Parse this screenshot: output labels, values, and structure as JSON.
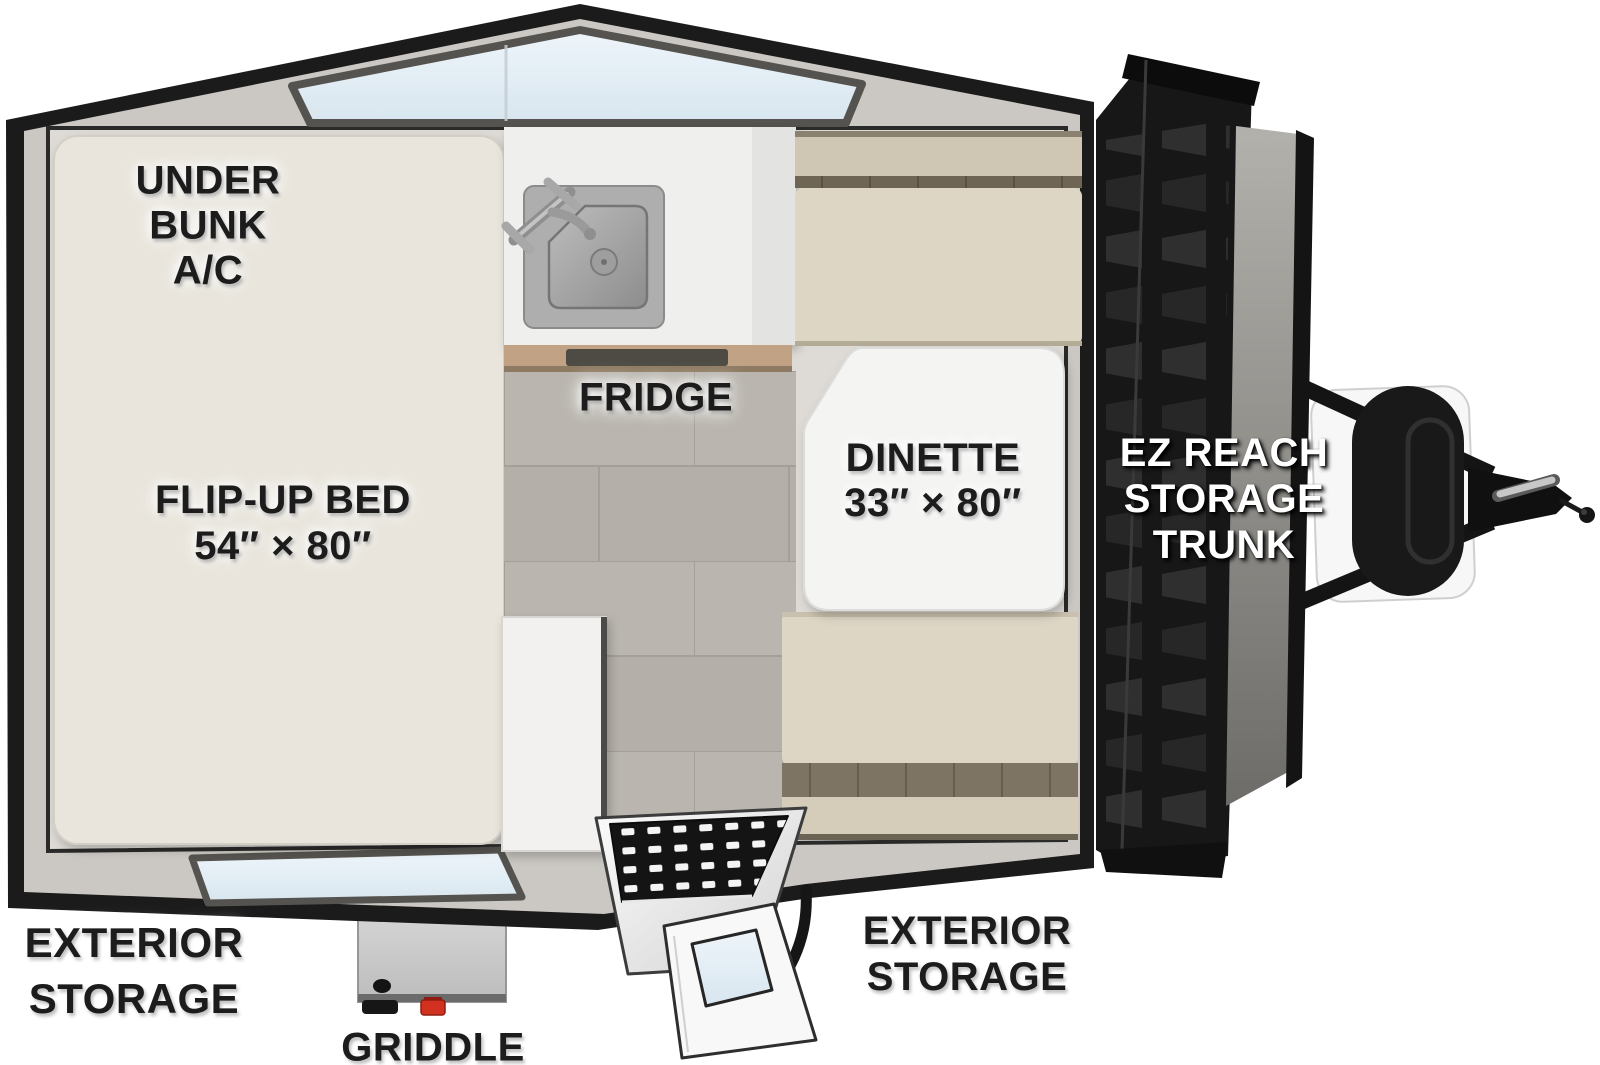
{
  "title": "A-frame camping trailer floorplan",
  "floorplan": {
    "labels": {
      "under_bunk_ac": "UNDER\nBUNK\nA/C",
      "flip_up_bed": "FLIP-UP BED\n54″ × 80″",
      "fridge": "FRIDGE",
      "dinette": "DINETTE\n33″ × 80″",
      "ez_reach_trunk": "EZ REACH\nSTORAGE\nTRUNK",
      "exterior_storage_left": "EXTERIOR\nSTORAGE",
      "exterior_storage_right": "EXTERIOR\nSTORAGE",
      "griddle": "GRIDDLE"
    },
    "dimensions": {
      "flip_up_bed": "54″ × 80″",
      "dinette": "33″ × 80″"
    },
    "colors": {
      "shell": "#1b1b1b",
      "wall_band": "#cbc8c3",
      "interior": "#dedbd6",
      "mattress": "#e9e5dc",
      "cushion": "#ded6c5",
      "cushion_seam": "#6e6555",
      "tile_floor": "#b9b5ae",
      "counter": "#efefee",
      "wood_trim": "#c2a284",
      "window_glass": "#e3edf4",
      "table": "#f4f4f3",
      "trunk": "#161616",
      "griddle_valve_red": "#d2311f"
    }
  }
}
